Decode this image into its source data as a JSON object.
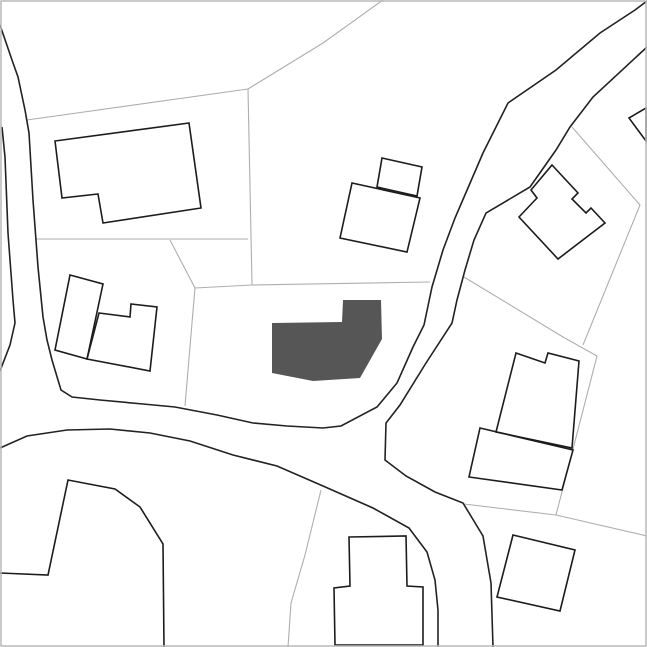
{
  "map": {
    "width": 647,
    "height": 647,
    "colors": {
      "background": "#ffffff",
      "building_fill": "#ffffff",
      "building_stroke": "#1c1c1c",
      "subject_building_fill": "#565656",
      "road_stroke": "#222222",
      "parcel_stroke": "#aeaeae",
      "frame_stroke": "#b9b9b9"
    },
    "stroke_widths": {
      "road": 1.6,
      "building": 1.6,
      "parcel": 1.1,
      "frame": 1.5
    },
    "parcel_lines": [
      {
        "name": "parcel-line-topleft-upper",
        "points": [
          [
            27,
            120
          ],
          [
            248,
            89
          ]
        ]
      },
      {
        "name": "parcel-line-topleft-diagonal",
        "points": [
          [
            248,
            89
          ],
          [
            323,
            43
          ],
          [
            383,
            0
          ]
        ]
      },
      {
        "name": "parcel-line-topleft-vertical",
        "points": [
          [
            248,
            89
          ],
          [
            252,
            285
          ]
        ]
      },
      {
        "name": "parcel-line-topleft-lower",
        "points": [
          [
            36,
            239
          ],
          [
            248,
            239
          ]
        ]
      },
      {
        "name": "parcel-line-center-west",
        "points": [
          [
            170,
            240
          ],
          [
            195,
            288
          ],
          [
            192,
            323
          ],
          [
            185,
            406
          ]
        ]
      },
      {
        "name": "parcel-line-center-north",
        "points": [
          [
            195,
            288
          ],
          [
            252,
            285
          ],
          [
            430,
            282
          ]
        ]
      },
      {
        "name": "parcel-line-east-main",
        "points": [
          [
            464,
            277
          ],
          [
            563,
            337
          ],
          [
            597,
            356
          ],
          [
            556,
            515
          ]
        ]
      },
      {
        "name": "parcel-line-east-upper",
        "points": [
          [
            572,
            127
          ],
          [
            640,
            205
          ],
          [
            583,
            345
          ]
        ]
      },
      {
        "name": "parcel-line-southeast-long",
        "points": [
          [
            464,
            504
          ],
          [
            556,
            515
          ],
          [
            647,
            536
          ]
        ]
      },
      {
        "name": "parcel-line-south-center",
        "points": [
          [
            321,
            490
          ],
          [
            305,
            555
          ],
          [
            291,
            603
          ],
          [
            288,
            647
          ]
        ]
      }
    ],
    "roads": [
      {
        "name": "road-edge-west-inner-and-north",
        "points": [
          [
            0,
            25
          ],
          [
            12,
            60
          ],
          [
            18,
            77
          ],
          [
            25,
            110
          ],
          [
            29,
            133
          ],
          [
            33,
            200
          ],
          [
            38,
            267
          ],
          [
            43,
            317
          ],
          [
            47,
            340
          ],
          [
            52,
            360
          ],
          [
            61,
            390
          ],
          [
            72,
            397
          ],
          [
            100,
            400
          ],
          [
            143,
            404
          ],
          [
            175,
            407
          ],
          [
            217,
            415
          ],
          [
            253,
            423
          ],
          [
            287,
            426
          ],
          [
            323,
            428
          ],
          [
            341,
            426
          ],
          [
            377,
            407
          ],
          [
            397,
            383
          ],
          [
            413,
            347
          ],
          [
            424,
            325
          ],
          [
            432,
            287
          ],
          [
            443,
            250
          ],
          [
            455,
            218
          ],
          [
            483,
            153
          ],
          [
            508,
            103
          ],
          [
            556,
            70
          ],
          [
            600,
            33
          ],
          [
            635,
            10
          ],
          [
            647,
            1
          ]
        ]
      },
      {
        "name": "road-edge-west-outer",
        "points": [
          [
            2,
            127
          ],
          [
            5,
            157
          ],
          [
            8,
            233
          ],
          [
            13,
            300
          ],
          [
            15,
            323
          ],
          [
            10,
            345
          ],
          [
            0,
            371
          ]
        ]
      },
      {
        "name": "road-edge-east",
        "points": [
          [
            647,
            47
          ],
          [
            593,
            97
          ],
          [
            570,
            127
          ],
          [
            556,
            150
          ],
          [
            530,
            187
          ],
          [
            486,
            213
          ],
          [
            474,
            240
          ],
          [
            465,
            270
          ],
          [
            457,
            300
          ],
          [
            452,
            323
          ],
          [
            426,
            363
          ],
          [
            400,
            405
          ],
          [
            386,
            423
          ],
          [
            385,
            460
          ],
          [
            406,
            476
          ],
          [
            435,
            492
          ],
          [
            463,
            503
          ],
          [
            483,
            536
          ],
          [
            491,
            583
          ],
          [
            493,
            647
          ]
        ]
      },
      {
        "name": "road-edge-south",
        "points": [
          [
            0,
            448
          ],
          [
            27,
            436
          ],
          [
            67,
            430
          ],
          [
            110,
            429
          ],
          [
            150,
            433
          ],
          [
            190,
            441
          ],
          [
            233,
            455
          ],
          [
            277,
            466
          ],
          [
            323,
            486
          ],
          [
            373,
            508
          ],
          [
            409,
            528
          ],
          [
            427,
            552
          ],
          [
            435,
            580
          ],
          [
            438,
            610
          ],
          [
            438,
            647
          ]
        ]
      }
    ],
    "buildings": [
      {
        "name": "building-top-left",
        "points": [
          [
            55,
            141
          ],
          [
            189,
            123
          ],
          [
            201,
            208
          ],
          [
            103,
            223
          ],
          [
            98,
            194
          ],
          [
            62,
            198
          ]
        ]
      },
      {
        "name": "building-center-top-wing",
        "points": [
          [
            382,
            158
          ],
          [
            422,
            167
          ],
          [
            417,
            196
          ],
          [
            377,
            187
          ]
        ]
      },
      {
        "name": "building-center-top-main",
        "points": [
          [
            352,
            183
          ],
          [
            420,
            198
          ],
          [
            407,
            252
          ],
          [
            340,
            238
          ]
        ]
      },
      {
        "name": "building-top-right-house",
        "points": [
          [
            552,
            165
          ],
          [
            578,
            193
          ],
          [
            572,
            199
          ],
          [
            586,
            213
          ],
          [
            591,
            208
          ],
          [
            605,
            223
          ],
          [
            558,
            259
          ],
          [
            519,
            217
          ],
          [
            537,
            198
          ],
          [
            531,
            190
          ]
        ]
      },
      {
        "name": "building-right-edge-partial",
        "points": [
          [
            629,
            118
          ],
          [
            646,
            108
          ],
          [
            646,
            141
          ]
        ]
      },
      {
        "name": "building-right-middle-tall",
        "points": [
          [
            516,
            353
          ],
          [
            545,
            363
          ],
          [
            548,
            353
          ],
          [
            579,
            361
          ],
          [
            572,
            448
          ],
          [
            496,
            432
          ]
        ]
      },
      {
        "name": "building-right-middle-wide",
        "points": [
          [
            480,
            428
          ],
          [
            573,
            450
          ],
          [
            562,
            490
          ],
          [
            469,
            477
          ]
        ]
      },
      {
        "name": "building-left-middle-a",
        "points": [
          [
            70,
            275
          ],
          [
            103,
            284
          ],
          [
            87,
            359
          ],
          [
            55,
            350
          ]
        ]
      },
      {
        "name": "building-left-middle-b",
        "points": [
          [
            99,
            313
          ],
          [
            130,
            317
          ],
          [
            131,
            304
          ],
          [
            157,
            307
          ],
          [
            150,
            371
          ],
          [
            87,
            359
          ]
        ]
      },
      {
        "name": "building-bottom-right-square",
        "points": [
          [
            513,
            535
          ],
          [
            575,
            550
          ],
          [
            560,
            611
          ],
          [
            497,
            597
          ]
        ]
      },
      {
        "name": "building-bottom-center",
        "points": [
          [
            349,
            537
          ],
          [
            406,
            536
          ],
          [
            407,
            586
          ],
          [
            423,
            587
          ],
          [
            423,
            645
          ],
          [
            335,
            645
          ],
          [
            334,
            588
          ],
          [
            350,
            586
          ]
        ]
      }
    ],
    "subject_building": {
      "name": "subject-building",
      "points": [
        [
          272,
          323
        ],
        [
          342,
          322
        ],
        [
          343,
          300
        ],
        [
          381,
          300
        ],
        [
          382,
          339
        ],
        [
          360,
          378
        ],
        [
          313,
          381
        ],
        [
          272,
          373
        ]
      ]
    },
    "outline_shapes": [
      {
        "name": "structure-bottom-left",
        "points": [
          [
            0,
            573
          ],
          [
            48,
            575
          ],
          [
            68,
            480
          ],
          [
            115,
            489
          ],
          [
            140,
            507
          ],
          [
            163,
            544
          ],
          [
            164,
            647
          ]
        ]
      }
    ]
  }
}
